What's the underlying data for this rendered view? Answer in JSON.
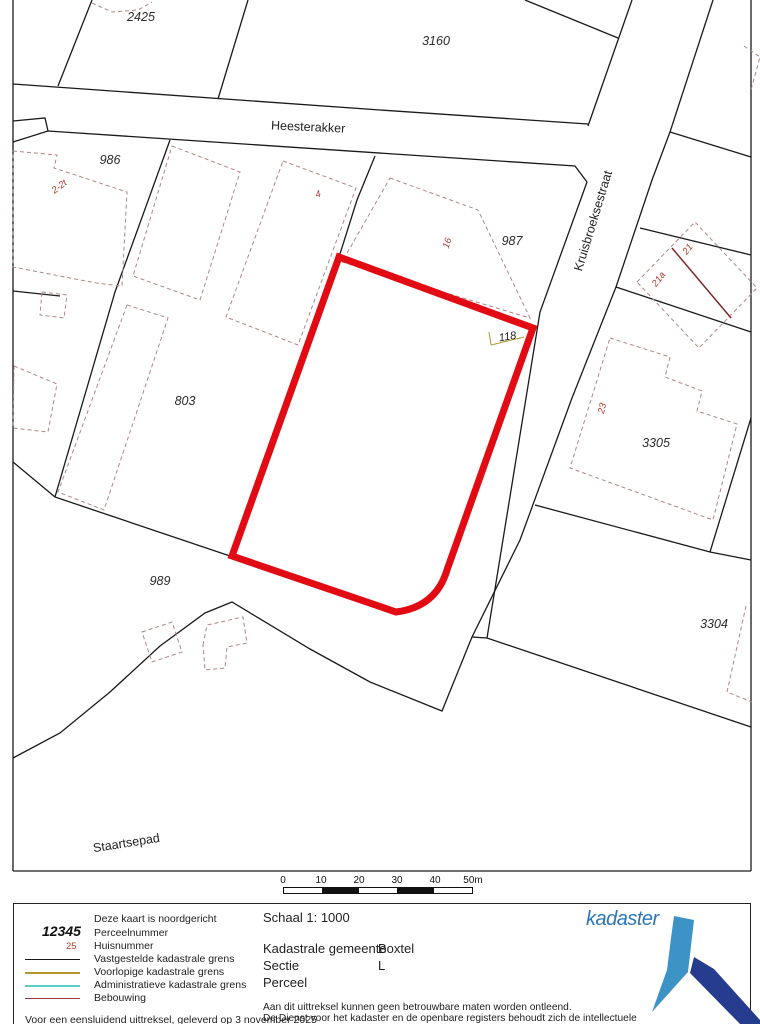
{
  "map": {
    "parcel_labels": [
      {
        "text": "2425"
      },
      {
        "text": "3160"
      },
      {
        "text": "986"
      },
      {
        "text": "987"
      },
      {
        "text": "803"
      },
      {
        "text": "989"
      },
      {
        "text": "3305"
      },
      {
        "text": "3304"
      }
    ],
    "street_labels": [
      {
        "text": "Heesterakker"
      },
      {
        "text": "Kruisbroeksestraat"
      },
      {
        "text": "Staartsepad"
      }
    ],
    "house_numbers": [
      {
        "text": "2-2t"
      },
      {
        "text": "4"
      },
      {
        "text": "16"
      },
      {
        "text": "21"
      },
      {
        "text": "21a"
      },
      {
        "text": "23"
      }
    ],
    "highlighted_parcel_number": "118",
    "highlight_color": "#e30b13",
    "boundary_color": "#1a1a1a",
    "building_color": "#b38585"
  },
  "scale_bar": {
    "labels": [
      "0",
      "10",
      "20",
      "30",
      "40",
      "50m"
    ]
  },
  "legend": {
    "north_note": "Deze kaart is noordgericht",
    "items": [
      {
        "symbol": "12345",
        "label": "Perceelnummer"
      },
      {
        "symbol": "25",
        "label": "Huisnummer"
      },
      {
        "symbol": "line",
        "label": "Vastgestelde kadastrale grens",
        "color": "#1a1a1a"
      },
      {
        "symbol": "line",
        "label": "Voorlopige kadastrale grens",
        "color": "#b5952f"
      },
      {
        "symbol": "line",
        "label": "Administratieve kadastrale grens",
        "color": "#57cfc4"
      },
      {
        "symbol": "line",
        "label": "Bebouwing",
        "color": "#9c3a3a"
      }
    ],
    "footer_note": "Voor een eensluidend uittreksel, geleverd op 3 november 2025"
  },
  "info": {
    "schaal": "Schaal 1: 1000",
    "fields": [
      {
        "label": "Kadastrale gemeente",
        "value": "Boxtel"
      },
      {
        "label": "Sectie",
        "value": "L"
      },
      {
        "label": "Perceel",
        "value": ""
      }
    ],
    "disclaimer_line1": "Aan dit uittreksel kunnen geen betrouwbare maten worden ontleend.",
    "disclaimer_line2": "De Dienst voor het kadaster en de openbare registers behoudt zich de intellectuele"
  },
  "logo": {
    "text": "kadaster",
    "text_color": "#2e75b5",
    "light_color": "#3d93c5",
    "dark_color": "#263d8f"
  }
}
